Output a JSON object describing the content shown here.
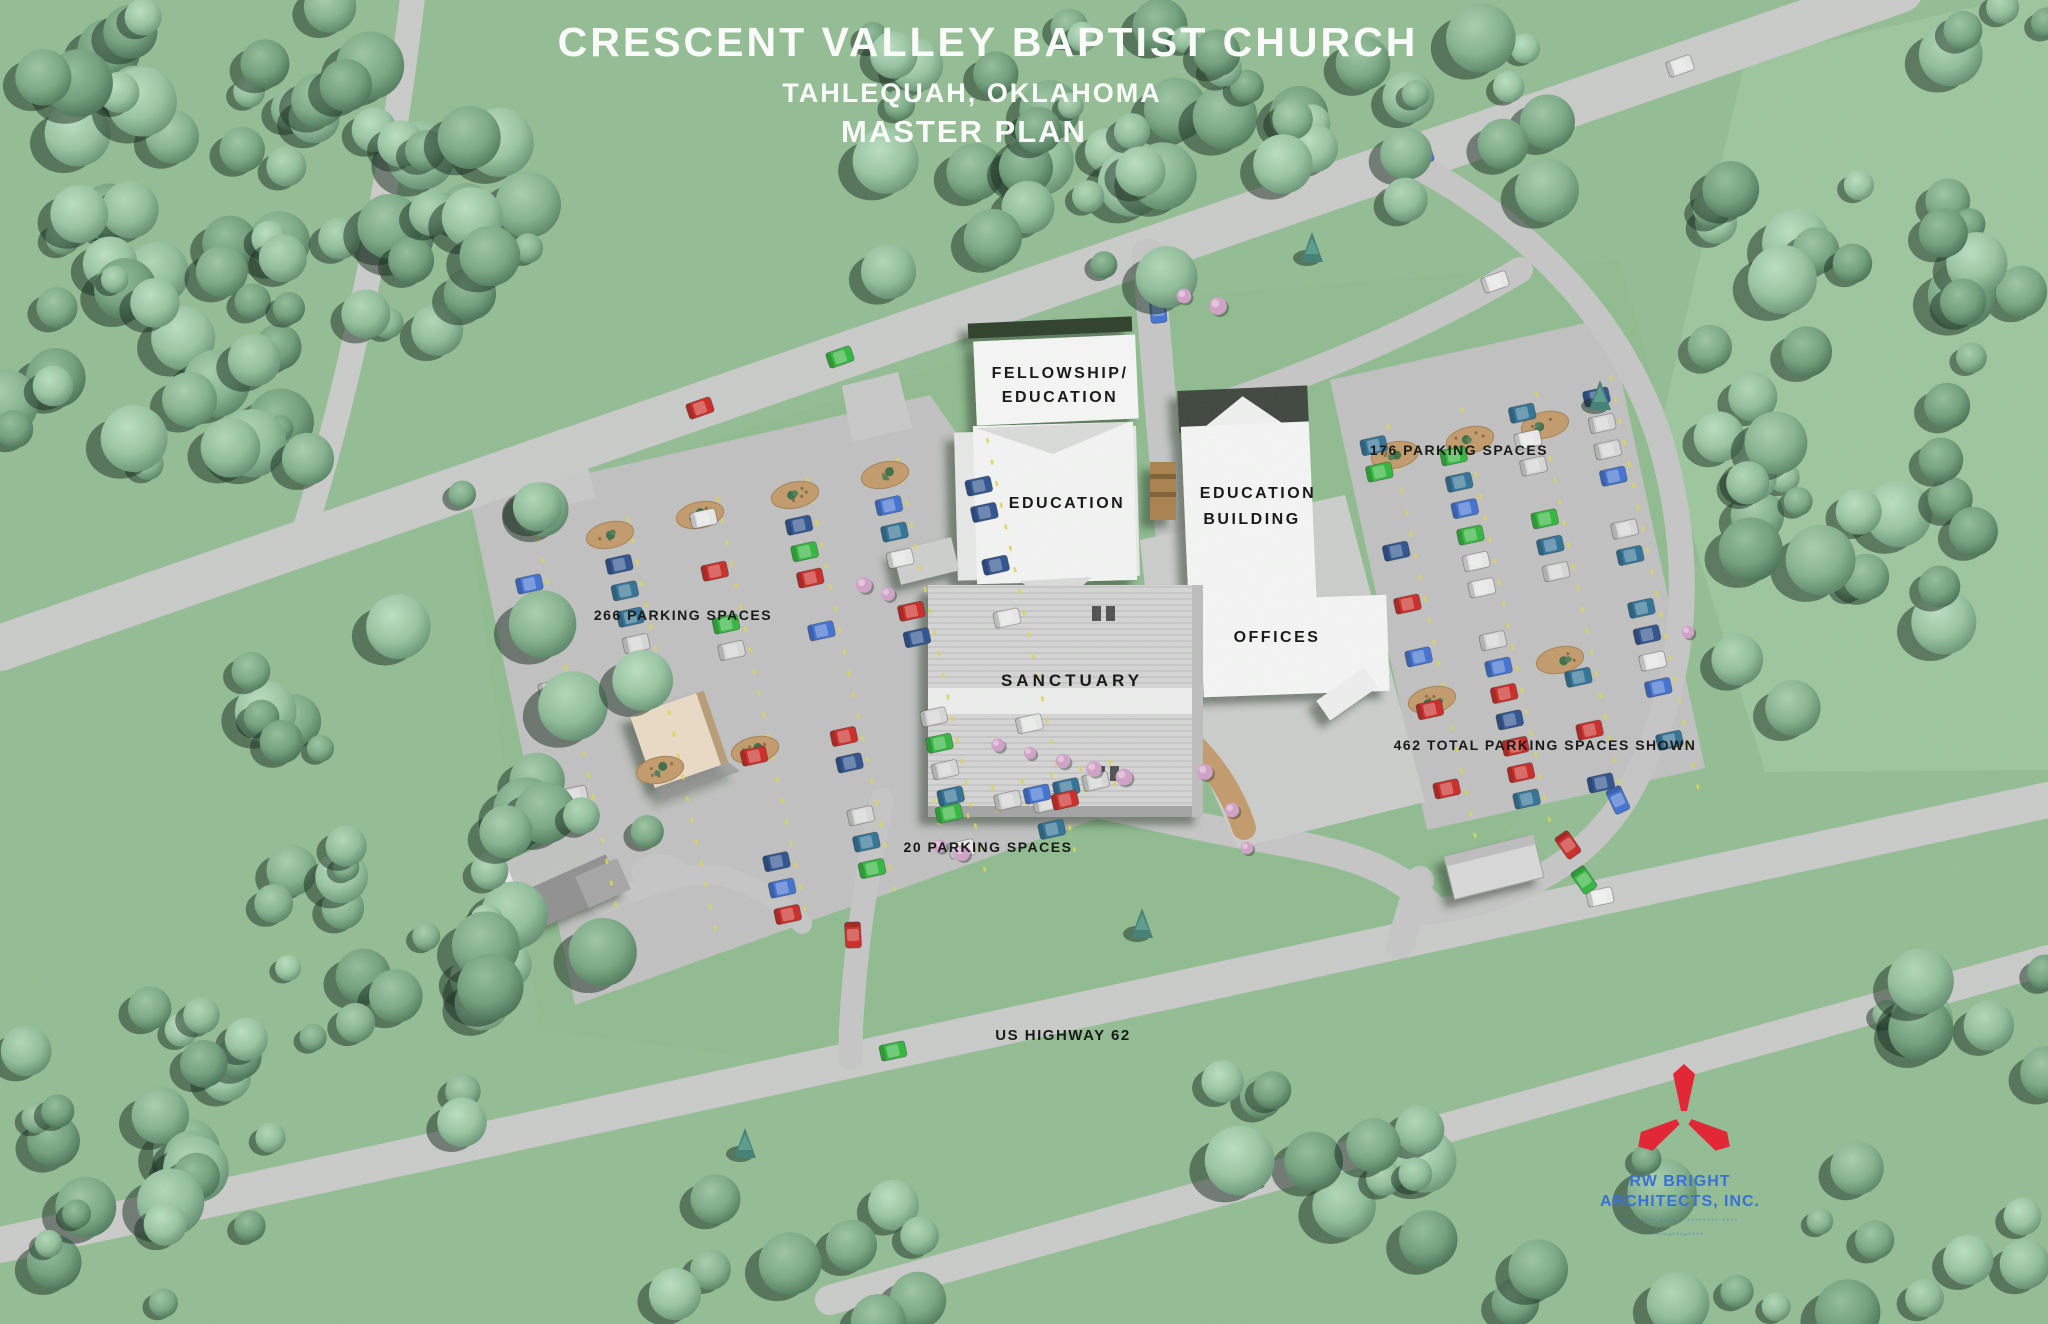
{
  "title": {
    "line1": "CRESCENT VALLEY BAPTIST CHURCH",
    "line2": "TAHLEQUAH, OKLAHOMA",
    "line3": "MASTER PLAN"
  },
  "buildings": {
    "fellowship_line1": "FELLOWSHIP/",
    "fellowship_line2": "EDUCATION",
    "education": "EDUCATION",
    "education_building_line1": "EDUCATION",
    "education_building_line2": "BUILDING",
    "offices": "OFFICES",
    "sanctuary": "SANCTUARY"
  },
  "parking": {
    "west_lot": "266 PARKING SPACES",
    "east_lot": "176 PARKING SPACES",
    "south_lot": "20 PARKING SPACES",
    "total": "462 TOTAL PARKING SPACES SHOWN"
  },
  "roads": {
    "highway": "US HIGHWAY 62"
  },
  "logo": {
    "firm_line1": "RW BRIGHT",
    "firm_line2": "ARCHITECTS, INC.",
    "small_print_line1": "··· ····· ···· · ········ ····",
    "small_print_line2": "···‑···‑····"
  },
  "colors": {
    "grass": "#93bd93",
    "grass_light": "#9dc69d",
    "road": "#c9c9c9",
    "lot": "#c1c1c1",
    "building": "#f7f7f7",
    "roof": "#d2d2d2",
    "title_text": "#ffffff",
    "label_text": "#0d0d0d",
    "logo_red": "#e61b2d",
    "logo_blue": "#2f6bd8",
    "mulch": "#c49a6a",
    "stripe": "#ddd84f",
    "car_palette": [
      "#cd2623",
      "#2fb73a",
      "#3f6fd3",
      "#2e7096",
      "#e9e9e9",
      "#2b4f8e",
      "#d8d8d8"
    ]
  }
}
